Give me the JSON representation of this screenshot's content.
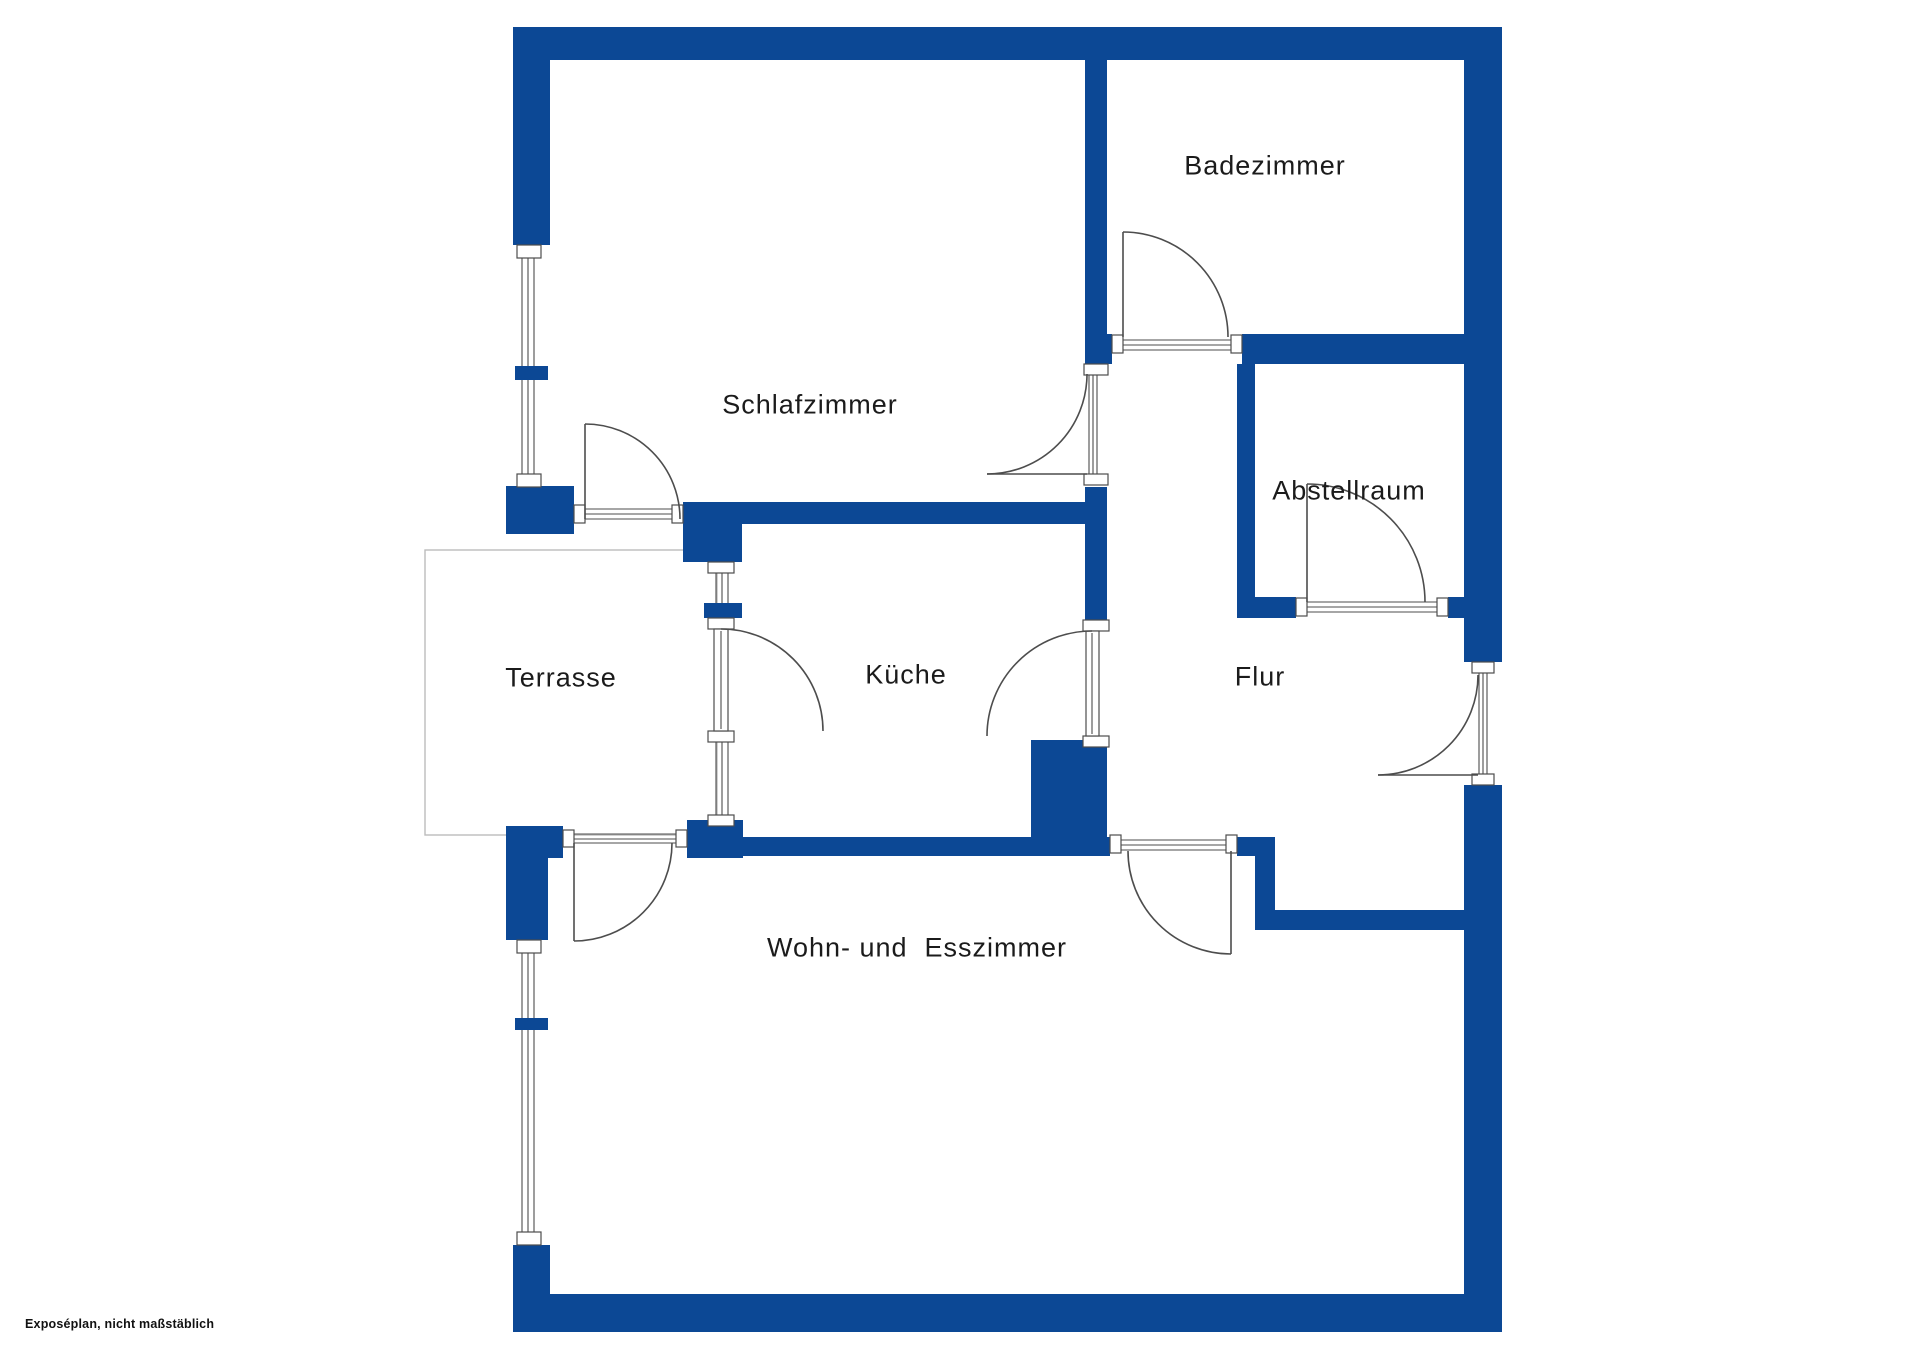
{
  "plan": {
    "type": "floor-plan",
    "rooms": [
      {
        "id": "badezimmer",
        "name": "Badezimmer"
      },
      {
        "id": "schlafzimmer",
        "name": "Schlafzimmer"
      },
      {
        "id": "abstellraum",
        "name": "Abstellraum"
      },
      {
        "id": "terrasse",
        "name": "Terrasse"
      },
      {
        "id": "kueche",
        "name": "Küche"
      },
      {
        "id": "flur",
        "name": "Flur"
      },
      {
        "id": "wohn_esszimmer",
        "name": "Wohn- und  Esszimmer"
      }
    ],
    "features": {
      "doors": 9,
      "windows": [
        "left wall Schlafzimmer",
        "left wall Wohn- und Esszimmer",
        "Terrasse/Küche wall"
      ],
      "entrance": "right wall at Flur"
    }
  },
  "footer": {
    "disclaimer": "Exposéplan, nicht maßstäblich"
  },
  "colors": {
    "wall": "#0c4895",
    "line": "#4d4d4d",
    "terrace_outline": "#bcbcbc",
    "text": "#1b1b1b",
    "background": "#ffffff"
  }
}
